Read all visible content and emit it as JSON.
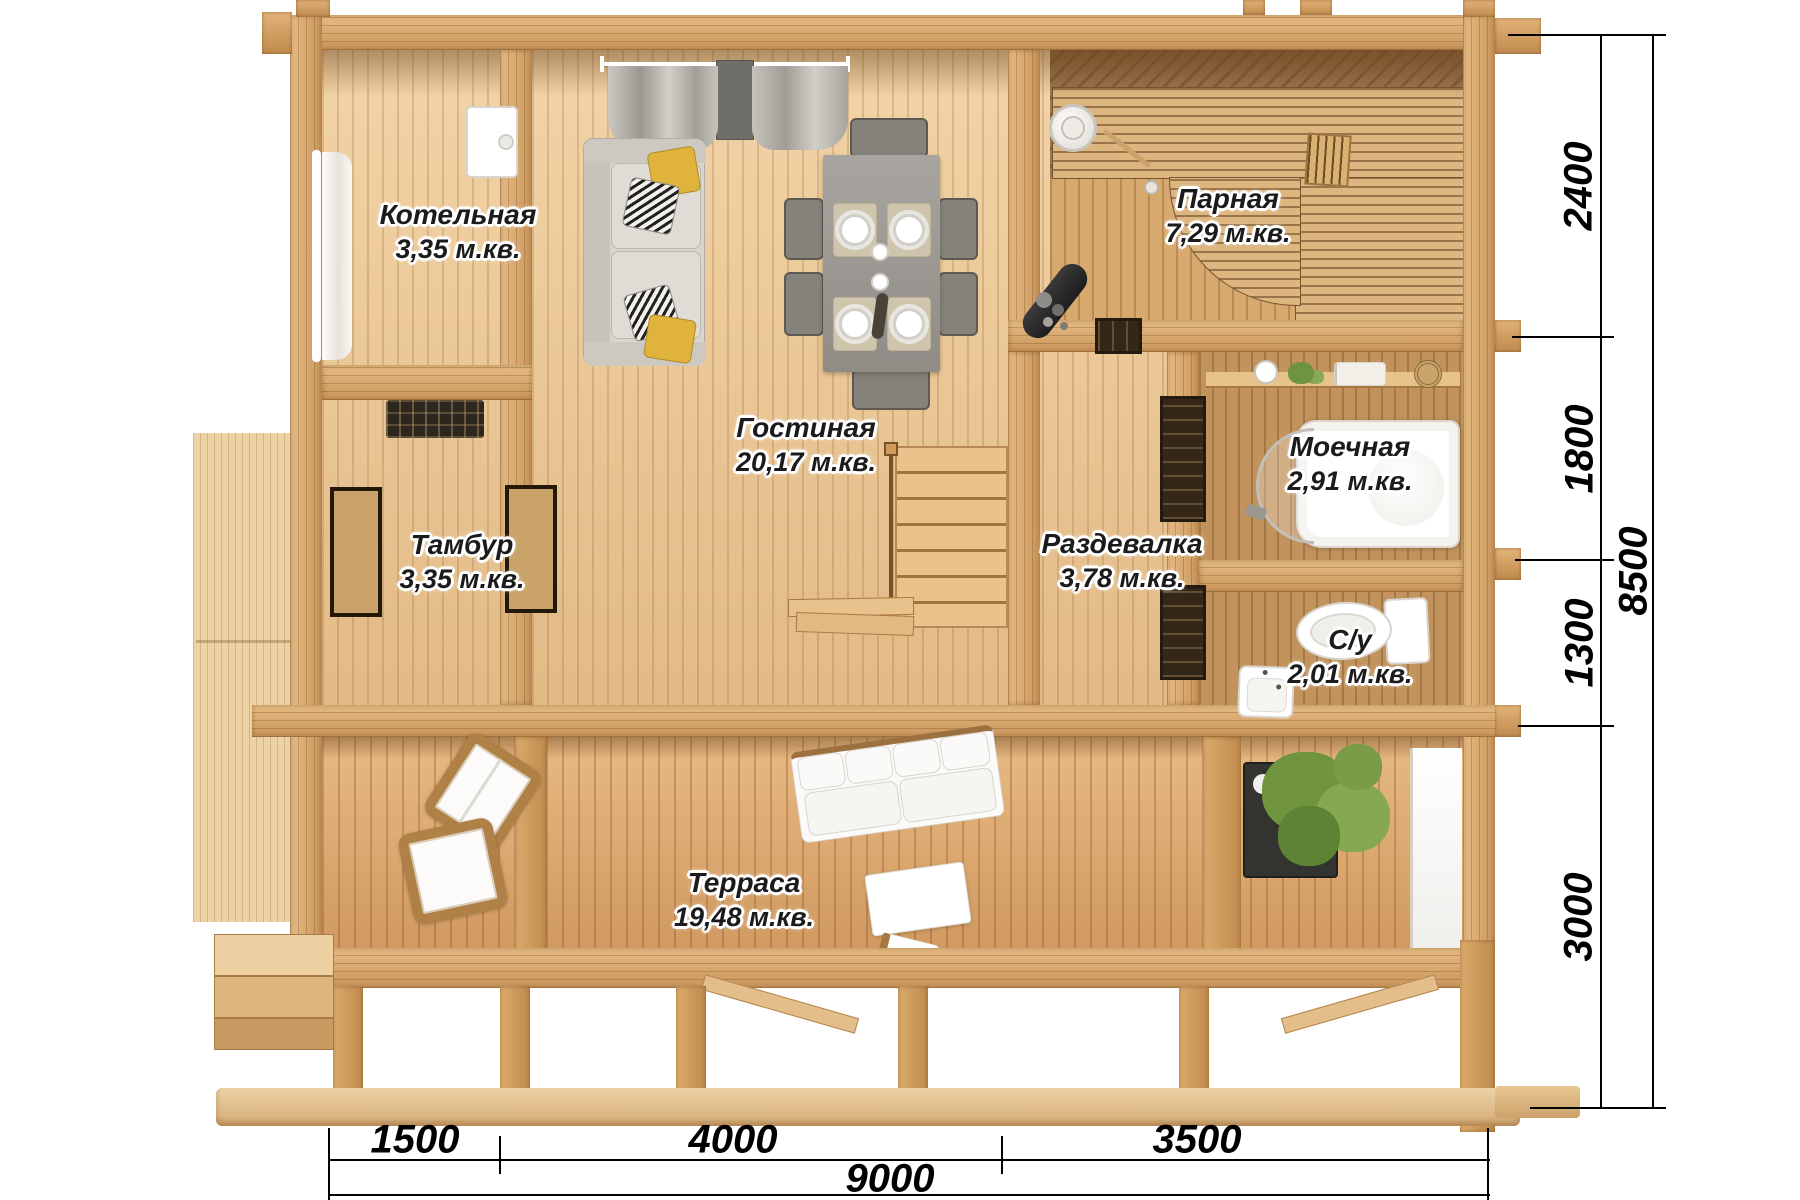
{
  "rooms": [
    {
      "label": "Котельная",
      "area": "3,35 м.кв."
    },
    {
      "label": "Тамбур",
      "area": "3,35 м.кв."
    },
    {
      "label": "Гостиная",
      "area": "20,17 м.кв."
    },
    {
      "label": "Парная",
      "area": "7,29 м.кв."
    },
    {
      "label": "Моечная",
      "area": "2,91 м.кв."
    },
    {
      "label": "Раздевалка",
      "area": "3,78 м.кв."
    },
    {
      "label": "С/у",
      "area": "2,01 м.кв."
    },
    {
      "label": "Терраса",
      "area": "19,48 м.кв."
    }
  ],
  "dimensions": {
    "right_segments": [
      {
        "value": "2400"
      },
      {
        "value": "1800"
      },
      {
        "value": "1300"
      },
      {
        "value": "3000"
      }
    ],
    "right_total": "8500",
    "bottom_segments": [
      {
        "value": "1500"
      },
      {
        "value": "4000"
      },
      {
        "value": "3500"
      }
    ],
    "bottom_total": "9000"
  },
  "colors": {
    "wall_wood": "#dcab6e",
    "interior_floor": "#ecc795",
    "terrace_floor": "#e0ab70",
    "sauna_floor": "#8f6a42",
    "accent_pillow": "#e0b33c",
    "dimension_text": "#000000"
  }
}
